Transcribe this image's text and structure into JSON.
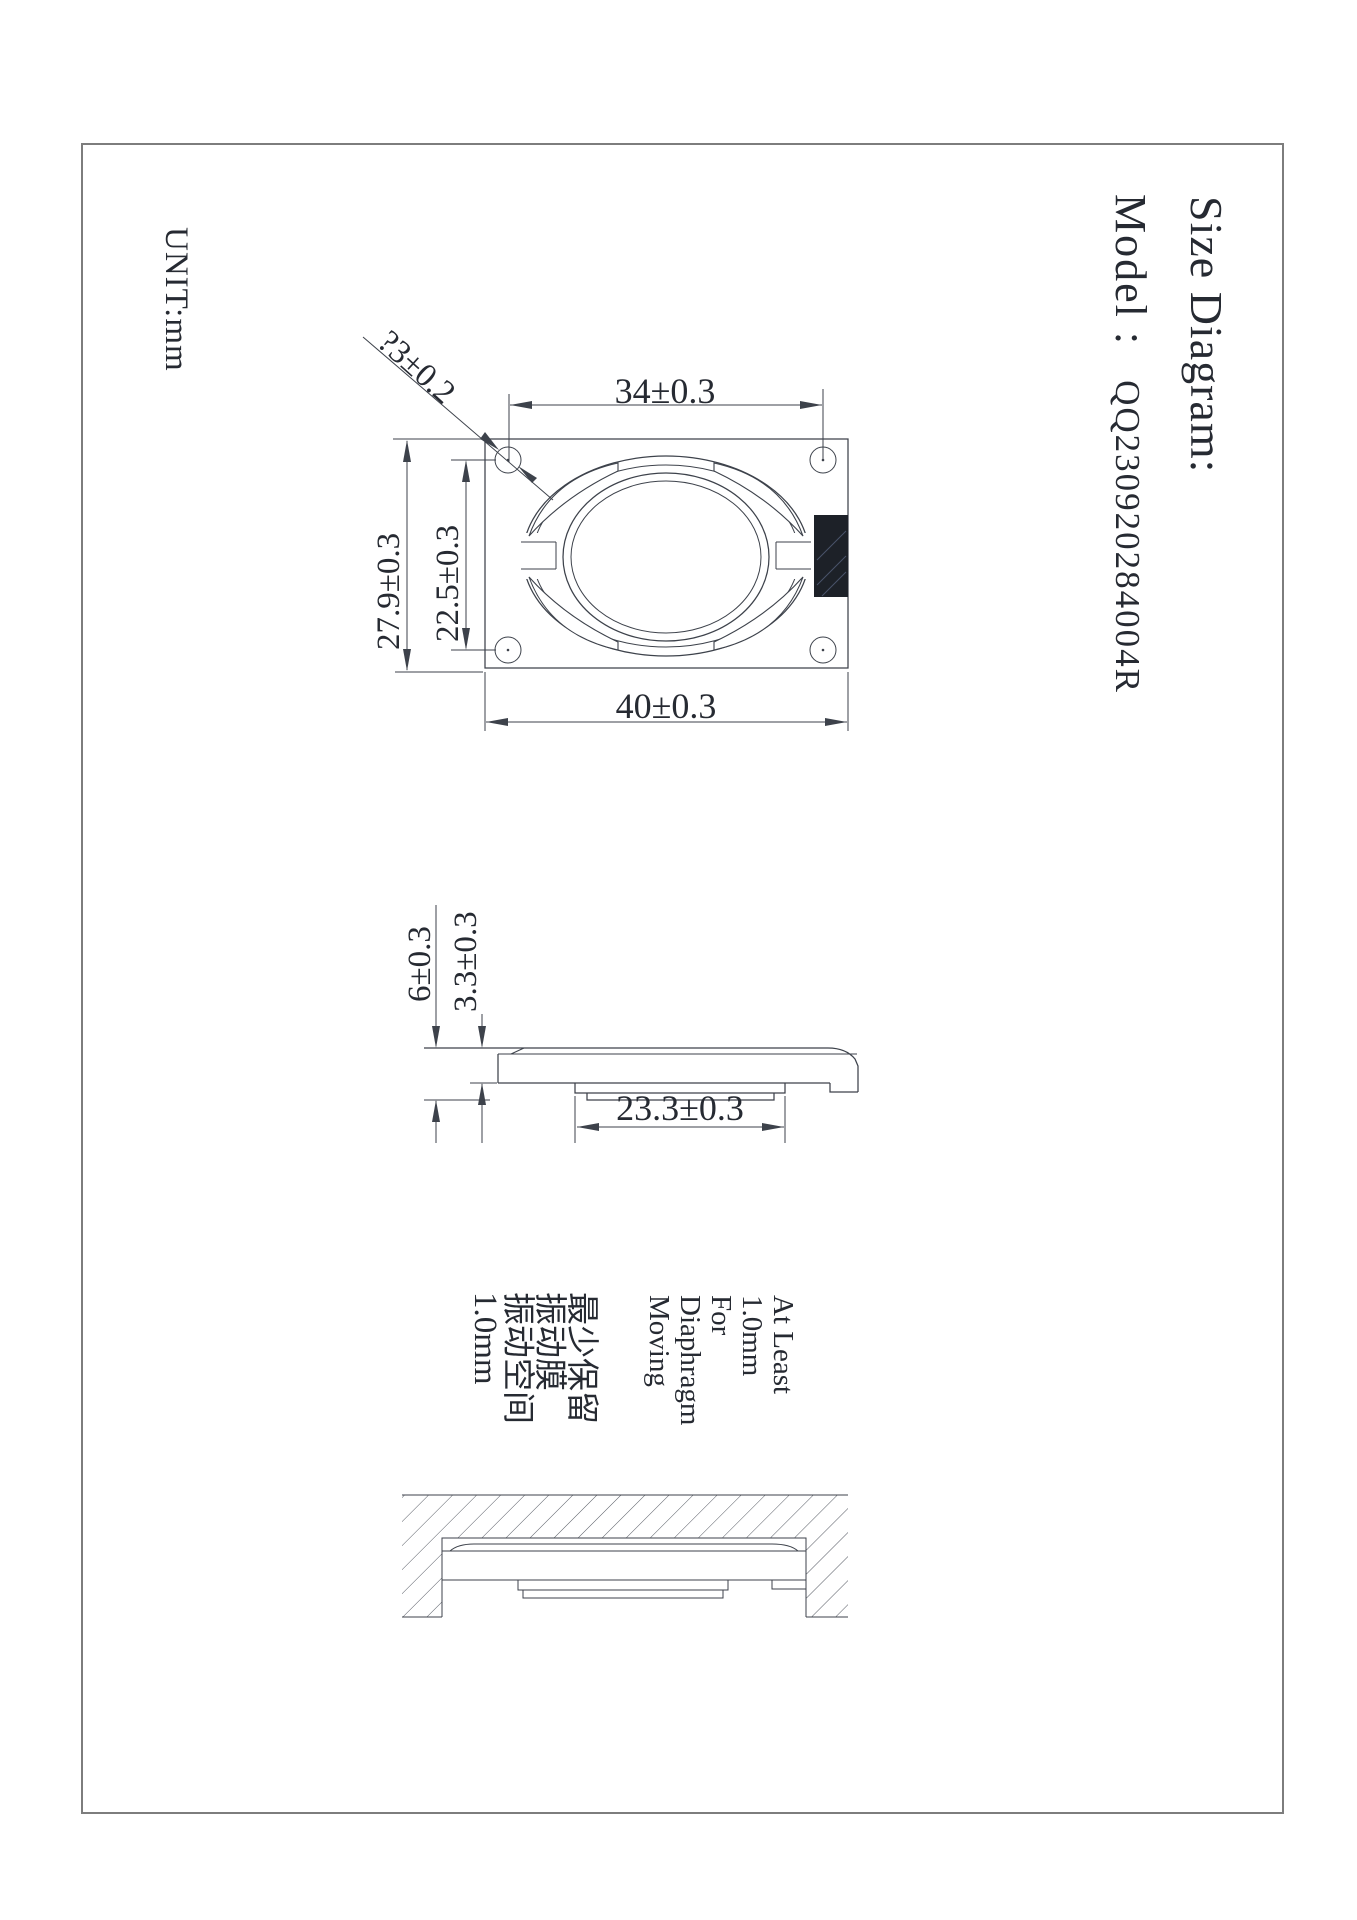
{
  "colors": {
    "line": "#3d424b",
    "text": "#262a32",
    "pad": "#1d2128",
    "border": "#7d7d7d",
    "hatch": "#565b64"
  },
  "title_block": {
    "title": "Size Diagram:",
    "model_label": "Model :",
    "model_value": "QQ230920284004R",
    "unit_label": "UNIT:mm"
  },
  "top_view": {
    "dim_hole_span_h": "34±0.3",
    "dim_width": "40±0.3",
    "dim_height": "27.9±0.3",
    "dim_hole_span_v": "22.5±0.3",
    "dim_hole_diameter": "?3±0.2"
  },
  "side_view": {
    "dim_total_thickness": "6±0.3",
    "dim_frame_thickness": "3.3±0.3",
    "dim_magnet_width": "23.3±0.3"
  },
  "clearance_note": {
    "en_lines": [
      "At Least",
      "1.0mm",
      "For",
      "Diaphragm",
      "Moving"
    ],
    "cn_lines": [
      "最少保留",
      "振动膜",
      "振动空间",
      "1.0mm"
    ]
  }
}
